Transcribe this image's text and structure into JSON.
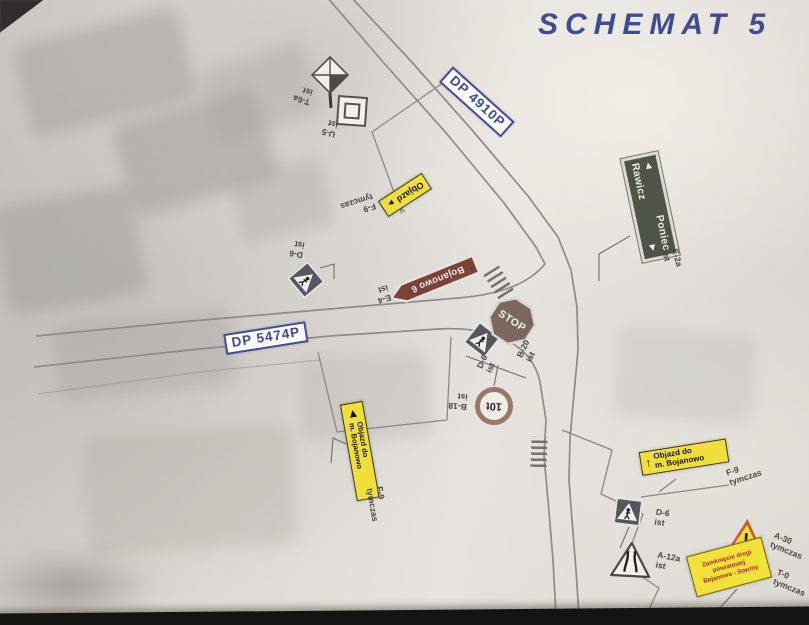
{
  "title": "SCHEMAT 5",
  "road_labels": {
    "dp4910": "DP 4910P",
    "dp5474": "DP 5474P"
  },
  "signs": {
    "marker_diamond": {
      "label": "T-6a\nist"
    },
    "marker_square": {
      "label": "U-5\nist"
    },
    "objazd_top": {
      "text": "Objazd",
      "arrow": "►",
      "label": "F-9\ntymczas"
    },
    "bojanowo": {
      "text": "Bojanowo 6",
      "label": "E-4\nist"
    },
    "d6_nw": {
      "label": "D-6\nist"
    },
    "stop": {
      "text": "STOP",
      "label": "B-20\nist"
    },
    "d6_junction": {
      "label": "D-6\nist"
    },
    "b18": {
      "text": "10t",
      "label": "B-18\nist"
    },
    "objazd_west": {
      "arrow": "◄",
      "text": "Objazd do\nm. Bojanowo",
      "label": "F-9\ntymczas"
    },
    "poniec_rawicz": {
      "line1_arrow": "◄",
      "line1": "Poniec",
      "line2": "Rawicz",
      "line2_arrow": "►",
      "label": "E-2a\nist"
    },
    "objazd_se": {
      "arrow": "↑",
      "text": "Objazd do\nm. Bojanowo",
      "label": "F-9\ntymczas"
    },
    "d6_se": {
      "label": "D-6\nist"
    },
    "a12a": {
      "label": "A-12a\nist"
    },
    "a30": {
      "text": "!",
      "label": "A-30\ntymczas"
    },
    "t0": {
      "text": "Zamknięcie drogi\npowiatowej\nBojanowo - Sowiny",
      "label": "T-0\ntymczas"
    }
  },
  "colors": {
    "title_blue": "#3f4c94",
    "sign_yellow": "#f0df3a",
    "direction_green": "#4f5449",
    "locality_brown": "#7c4137",
    "warning_red": "#b5271e",
    "paper": "#dcd8d3"
  }
}
